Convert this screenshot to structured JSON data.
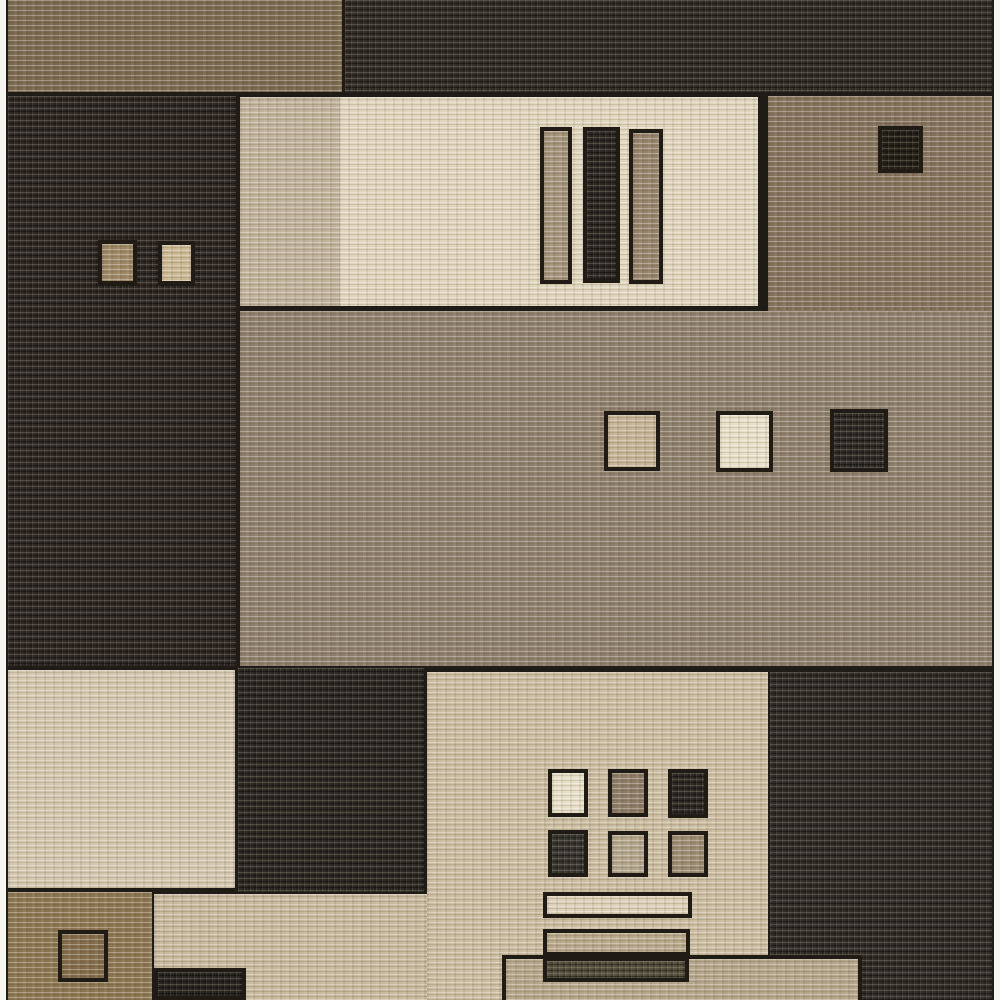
{
  "image": {
    "alt": "Overhead photo of a modern geometric color-block area rug in browns, beiges, creams and charcoal, with small inset squares and bars; thin white photo margins on left and right edges",
    "width": 1000,
    "height": 1000
  },
  "palette": {
    "photo_background": "#f6f5f1",
    "seam_dark": "#1f1b16",
    "charcoal": "#322d27",
    "brown": "#79674e",
    "taupe_brown": "#8c7e6a",
    "cream": "#e4dac3",
    "beige": "#cabca0"
  },
  "rug": {
    "x": 6,
    "y": 0,
    "w": 988,
    "h": 1000
  },
  "shapes": [
    {
      "name": "rug-base-seams",
      "x": 6,
      "y": 0,
      "w": 988,
      "h": 1000,
      "color": "#1f1b16",
      "texture": "none",
      "border": false
    },
    {
      "name": "block-brown-top-left",
      "x": 8,
      "y": 0,
      "w": 334,
      "h": 92,
      "color": "#79674e",
      "texture": "light",
      "border": false
    },
    {
      "name": "block-charcoal-top-band",
      "x": 345,
      "y": 0,
      "w": 647,
      "h": 92,
      "color": "#332e27",
      "texture": "dark",
      "border": false
    },
    {
      "name": "block-charcoal-left",
      "x": 8,
      "y": 96,
      "w": 228,
      "h": 570,
      "color": "#2f2a24",
      "texture": "dark",
      "border": false
    },
    {
      "name": "square-brown-in-left-block",
      "x": 98,
      "y": 240,
      "w": 39,
      "h": 45,
      "color": "#9c8765",
      "texture": "light",
      "border": true
    },
    {
      "name": "square-beige-in-left-block",
      "x": 158,
      "y": 241,
      "w": 37,
      "h": 44,
      "color": "#cab893",
      "texture": "light",
      "border": true
    },
    {
      "name": "block-cream-top",
      "x": 240,
      "y": 97,
      "w": 518,
      "h": 209,
      "color": "#e0d5bd",
      "texture": "light",
      "border": false
    },
    {
      "name": "shade-cream-top-left-edge",
      "x": 240,
      "y": 97,
      "w": 100,
      "h": 209,
      "color": "#c0b29a",
      "texture": "light",
      "border": false
    },
    {
      "name": "bar-taupe-vertical",
      "x": 540,
      "y": 127,
      "w": 32,
      "h": 157,
      "color": "#a2927a",
      "texture": "light",
      "border": true
    },
    {
      "name": "bar-charcoal-vertical",
      "x": 583,
      "y": 127,
      "w": 37,
      "h": 156,
      "color": "#2d2923",
      "texture": "dark",
      "border": true
    },
    {
      "name": "bar-brown-vertical",
      "x": 629,
      "y": 129,
      "w": 34,
      "h": 155,
      "color": "#95826a",
      "texture": "light",
      "border": true
    },
    {
      "name": "block-brown-top-right",
      "x": 768,
      "y": 96,
      "w": 224,
      "h": 215,
      "color": "#82705a",
      "texture": "light",
      "border": false
    },
    {
      "name": "square-charcoal-top-right",
      "x": 878,
      "y": 126,
      "w": 45,
      "h": 47,
      "color": "#272219",
      "texture": "dark",
      "border": true
    },
    {
      "name": "block-taupe-middle-band",
      "x": 240,
      "y": 311,
      "w": 752,
      "h": 355,
      "color": "#8c7e6a",
      "texture": "light",
      "border": false
    },
    {
      "name": "square-beige-middle",
      "x": 604,
      "y": 411,
      "w": 56,
      "h": 60,
      "color": "#c4b394",
      "texture": "light",
      "border": true
    },
    {
      "name": "square-cream-middle",
      "x": 716,
      "y": 411,
      "w": 57,
      "h": 61,
      "color": "#e8dfc8",
      "texture": "light",
      "border": true
    },
    {
      "name": "square-charcoal-middle",
      "x": 830,
      "y": 409,
      "w": 58,
      "h": 63,
      "color": "#312d27",
      "texture": "dark",
      "border": true
    },
    {
      "name": "block-cream-bottom-left",
      "x": 8,
      "y": 670,
      "w": 227,
      "h": 218,
      "color": "#d3c8af",
      "texture": "light",
      "border": false
    },
    {
      "name": "block-charcoal-bottom-midleft",
      "x": 238,
      "y": 668,
      "w": 186,
      "h": 224,
      "color": "#2d2923",
      "texture": "dark",
      "border": false
    },
    {
      "name": "block-beige-bottom-strip",
      "x": 154,
      "y": 894,
      "w": 273,
      "h": 106,
      "color": "#c7b99d",
      "texture": "light",
      "border": false
    },
    {
      "name": "block-beige-bottom-center",
      "x": 427,
      "y": 672,
      "w": 341,
      "h": 328,
      "color": "#cabca0",
      "texture": "light",
      "border": false
    },
    {
      "name": "grid-square-cream-r1c1",
      "x": 548,
      "y": 769,
      "w": 40,
      "h": 48,
      "color": "#e7dfc8",
      "texture": "light",
      "border": true
    },
    {
      "name": "grid-square-brown-r1c2",
      "x": 608,
      "y": 769,
      "w": 40,
      "h": 48,
      "color": "#8c7b65",
      "texture": "light",
      "border": true
    },
    {
      "name": "grid-square-charcoal-r1c3",
      "x": 668,
      "y": 769,
      "w": 40,
      "h": 49,
      "color": "#2e2b25",
      "texture": "dark",
      "border": true
    },
    {
      "name": "grid-square-charcoal-r2c1",
      "x": 548,
      "y": 830,
      "w": 40,
      "h": 47,
      "color": "#3a3831",
      "texture": "dark",
      "border": true
    },
    {
      "name": "grid-square-beige-r2c2",
      "x": 608,
      "y": 831,
      "w": 40,
      "h": 46,
      "color": "#b2a58b",
      "texture": "light",
      "border": true
    },
    {
      "name": "grid-square-taupe-r2c3",
      "x": 668,
      "y": 831,
      "w": 40,
      "h": 46,
      "color": "#9a8a70",
      "texture": "light",
      "border": true
    },
    {
      "name": "block-charcoal-bottom-right",
      "x": 770,
      "y": 672,
      "w": 222,
      "h": 328,
      "color": "#332e28",
      "texture": "dark",
      "border": false
    },
    {
      "name": "rect-tan-outlined-bottom",
      "x": 502,
      "y": 955,
      "w": 360,
      "h": 45,
      "color": "#b3a589",
      "texture": "light",
      "border": "no-bottom"
    },
    {
      "name": "bar-cream-horizontal",
      "x": 543,
      "y": 892,
      "w": 149,
      "h": 26,
      "color": "#dcd1b8",
      "texture": "light",
      "border": true
    },
    {
      "name": "bar-beige-horizontal",
      "x": 543,
      "y": 929,
      "w": 147,
      "h": 27,
      "color": "#b7a88b",
      "texture": "light",
      "border": true
    },
    {
      "name": "bar-darktaupe-horizontal",
      "x": 543,
      "y": 957,
      "w": 146,
      "h": 25,
      "color": "#56503e",
      "texture": "dark",
      "border": true
    },
    {
      "name": "block-brown-bottom-left",
      "x": 8,
      "y": 892,
      "w": 144,
      "h": 108,
      "color": "#8a744f",
      "texture": "light",
      "border": false
    },
    {
      "name": "square-brown-bottom-left",
      "x": 58,
      "y": 930,
      "w": 50,
      "h": 52,
      "color": "#806a49",
      "texture": "light",
      "border": true
    },
    {
      "name": "block-charcoal-small-bottom",
      "x": 154,
      "y": 968,
      "w": 92,
      "h": 32,
      "color": "#2a2621",
      "texture": "dark",
      "border": true
    }
  ]
}
